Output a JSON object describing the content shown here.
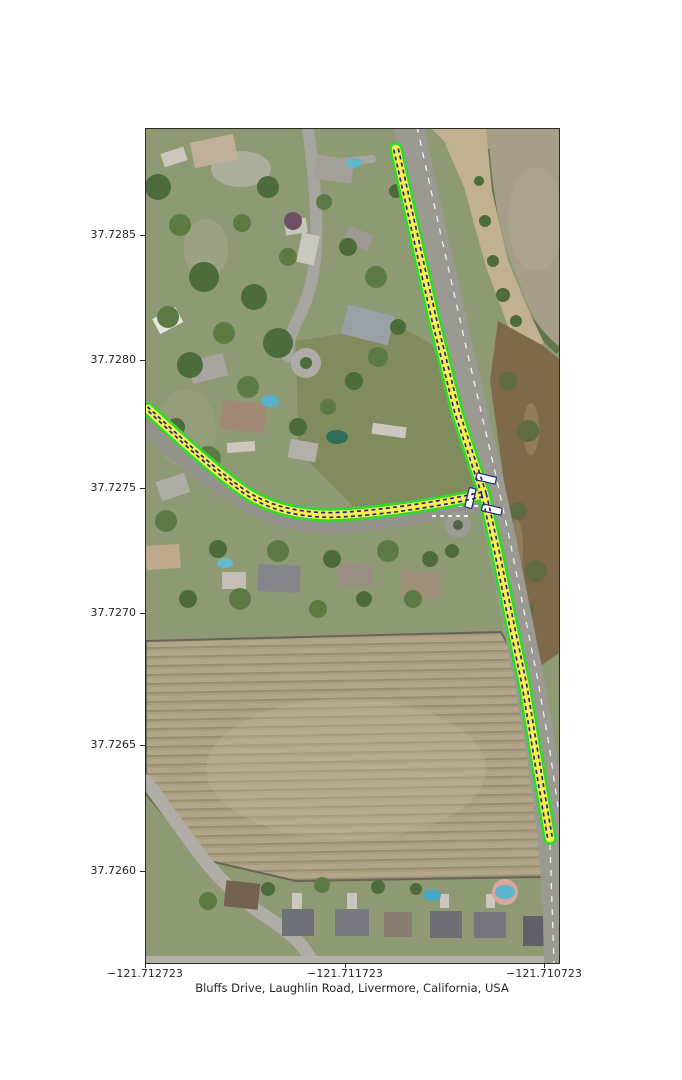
{
  "figure": {
    "caption": "Bluffs Drive, Laughlin Road, Livermore, California, USA"
  },
  "axes": {
    "y_ticks": [
      {
        "label": "37.7285"
      },
      {
        "label": "37.7280"
      },
      {
        "label": "37.7275"
      },
      {
        "label": "37.7270"
      },
      {
        "label": "37.7265"
      },
      {
        "label": "37.7260"
      }
    ],
    "x_ticks": [
      {
        "label": "−121.712723"
      },
      {
        "label": "−121.711723"
      },
      {
        "label": "−121.710723"
      }
    ]
  },
  "map": {
    "route": {
      "casing_color": "#33d633",
      "fill_color": "#f7ef50",
      "center_color": "#26267e",
      "crossing_fill": "#ffffff",
      "crossing_border": "#26267e"
    },
    "colors": {
      "water": "#a79e89",
      "bank": "#c1b190",
      "scrub": "#7e694a",
      "road": "#9b9a92",
      "field_fence": "#6b6452"
    }
  }
}
